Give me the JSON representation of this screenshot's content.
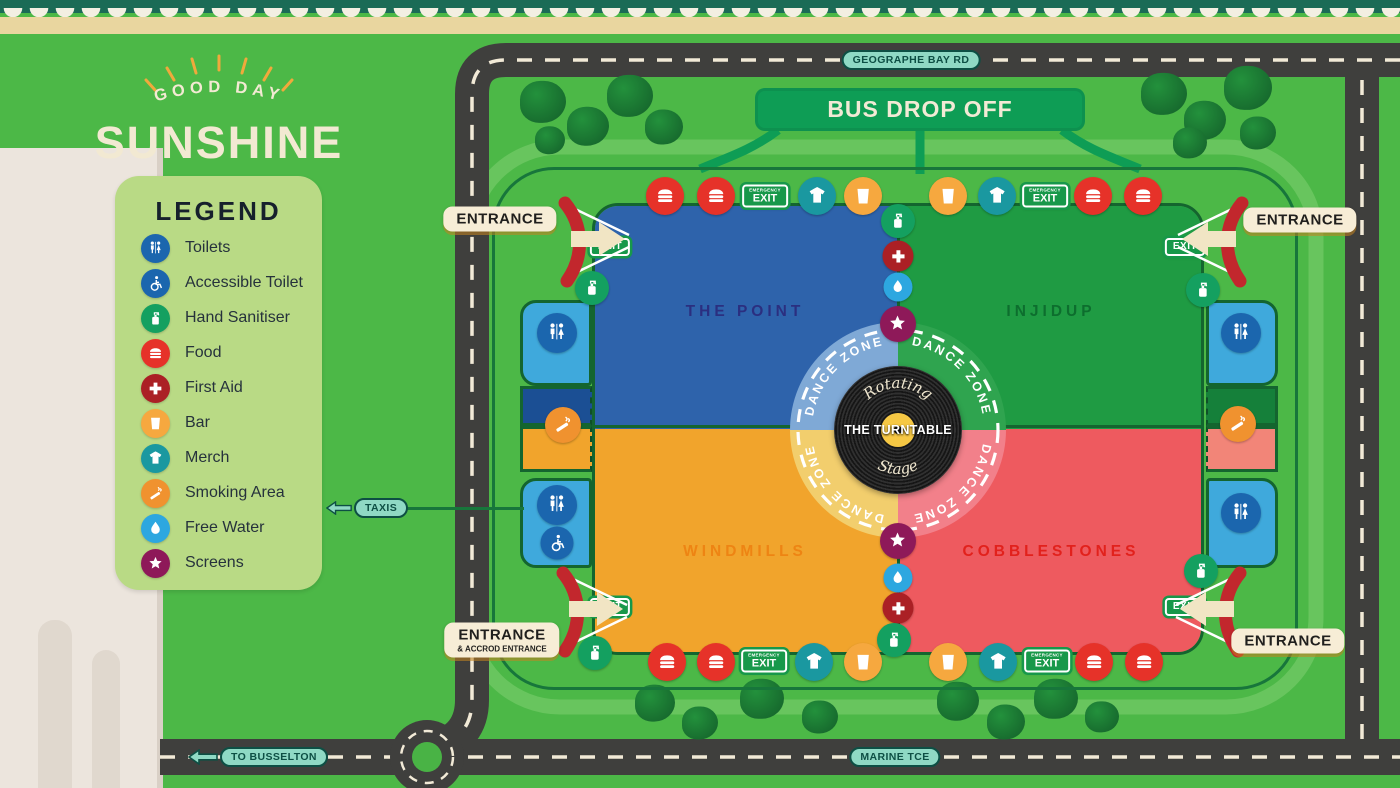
{
  "logo": {
    "tagline": "GOOD DAY",
    "title": "SUNSHINE"
  },
  "legend": {
    "title": "LEGEND",
    "items": [
      {
        "type": "toilets",
        "label": "Toilets",
        "color": "#1b66ae"
      },
      {
        "type": "accessible",
        "label": "Accessible Toilet",
        "color": "#1b66ae"
      },
      {
        "type": "sanitiser",
        "label": "Hand Sanitiser",
        "color": "#14a060"
      },
      {
        "type": "food",
        "label": "Food",
        "color": "#e63229"
      },
      {
        "type": "firstaid",
        "label": "First Aid",
        "color": "#ab2025"
      },
      {
        "type": "bar",
        "label": "Bar",
        "color": "#f6a83f"
      },
      {
        "type": "merch",
        "label": "Merch",
        "color": "#1a98a0"
      },
      {
        "type": "smoking",
        "label": "Smoking Area",
        "color": "#f0922f"
      },
      {
        "type": "water",
        "label": "Free Water",
        "color": "#2da7e0"
      },
      {
        "type": "screen",
        "label": "Screens",
        "color": "#8e1959"
      }
    ]
  },
  "roads": {
    "top": "GEOGRAPHE BAY RD",
    "bottom": "MARINE TCE",
    "west": "TO BUSSELTON",
    "taxis": "TAXIS"
  },
  "bus": {
    "label": "BUS DROP OFF"
  },
  "zones": {
    "nw": {
      "name": "THE POINT",
      "fill": "#2e63ab",
      "label_color": "#2b2f80"
    },
    "ne": {
      "name": "INJIDUP",
      "fill": "#1f9b43",
      "label_color": "#0d6e2e"
    },
    "sw": {
      "name": "WINDMILLS",
      "fill": "#f1a42c",
      "label_color": "#ee8413"
    },
    "se": {
      "name": "COBBLESTONES",
      "fill": "#ee5a5f",
      "label_color": "#e2211c"
    }
  },
  "stage": {
    "name": "THE TURNTABLE",
    "script_top": "Rotating",
    "script_bottom": "Stage",
    "dance_zone": "DANCE ZONE"
  },
  "signs": {
    "exit": "EXIT",
    "emergency": "EMERGENCY"
  },
  "entrances": [
    {
      "corner": "nw",
      "label": "ENTRANCE",
      "sub": "",
      "x": 500,
      "y": 219
    },
    {
      "corner": "ne",
      "label": "ENTRANCE",
      "sub": "",
      "x": 1300,
      "y": 220
    },
    {
      "corner": "sw",
      "label": "ENTRANCE",
      "sub": "& ACCROD ENTRANCE",
      "x": 502,
      "y": 640
    },
    {
      "corner": "se",
      "label": "ENTRANCE",
      "sub": "",
      "x": 1288,
      "y": 641
    }
  ],
  "markers": [
    [
      "food",
      665,
      196
    ],
    [
      "food",
      716,
      196
    ],
    [
      "emexit",
      765,
      196
    ],
    [
      "merch",
      817,
      196
    ],
    [
      "bar",
      863,
      196
    ],
    [
      "bar",
      948,
      196
    ],
    [
      "merch",
      997,
      196
    ],
    [
      "emexit",
      1045,
      196
    ],
    [
      "food",
      1093,
      196
    ],
    [
      "food",
      1143,
      196
    ],
    [
      "sanitiser",
      898,
      221
    ],
    [
      "firstaid",
      898,
      256
    ],
    [
      "water",
      898,
      287
    ],
    [
      "screen",
      898,
      324
    ],
    [
      "screen",
      898,
      541
    ],
    [
      "water",
      898,
      578
    ],
    [
      "firstaid",
      898,
      608
    ],
    [
      "sanitiser",
      894,
      640
    ],
    [
      "food",
      667,
      662
    ],
    [
      "food",
      716,
      662
    ],
    [
      "emexit",
      764,
      661
    ],
    [
      "merch",
      814,
      662
    ],
    [
      "bar",
      863,
      662
    ],
    [
      "bar",
      948,
      662
    ],
    [
      "merch",
      998,
      662
    ],
    [
      "emexit",
      1047,
      661
    ],
    [
      "food",
      1094,
      662
    ],
    [
      "food",
      1144,
      662
    ],
    [
      "sanitiser",
      592,
      288
    ],
    [
      "toilets",
      557,
      333
    ],
    [
      "smoking",
      563,
      425
    ],
    [
      "toilets",
      557,
      505
    ],
    [
      "accessible",
      557,
      543
    ],
    [
      "sanitiser",
      595,
      653
    ],
    [
      "sanitiser",
      1203,
      290
    ],
    [
      "toilets",
      1241,
      333
    ],
    [
      "smoking",
      1238,
      424
    ],
    [
      "toilets",
      1241,
      513
    ],
    [
      "sanitiser",
      1201,
      571
    ],
    [
      "exit",
      610,
      247
    ],
    [
      "exit",
      1185,
      247
    ],
    [
      "exit",
      610,
      607
    ],
    [
      "exit",
      1185,
      607
    ]
  ],
  "trees": [
    [
      543,
      102,
      46
    ],
    [
      588,
      126,
      42
    ],
    [
      630,
      96,
      46
    ],
    [
      664,
      127,
      38
    ],
    [
      550,
      140,
      30
    ],
    [
      1164,
      94,
      46
    ],
    [
      1205,
      120,
      42
    ],
    [
      1248,
      88,
      48
    ],
    [
      1190,
      143,
      34
    ],
    [
      1258,
      133,
      36
    ],
    [
      655,
      703,
      40
    ],
    [
      700,
      723,
      36
    ],
    [
      762,
      699,
      44
    ],
    [
      820,
      717,
      36
    ],
    [
      958,
      701,
      42
    ],
    [
      1006,
      722,
      38
    ],
    [
      1056,
      699,
      44
    ],
    [
      1102,
      717,
      34
    ]
  ],
  "colors": {
    "dance_nw": "#7fa9d6",
    "dance_ne": "#2fa44f",
    "dance_sw": "#f2ce6d",
    "dance_se": "#f2808a",
    "road": "#3f3f3d",
    "field": "#4cb847",
    "fence": "#17763b",
    "accent_red": "#c2272d"
  }
}
